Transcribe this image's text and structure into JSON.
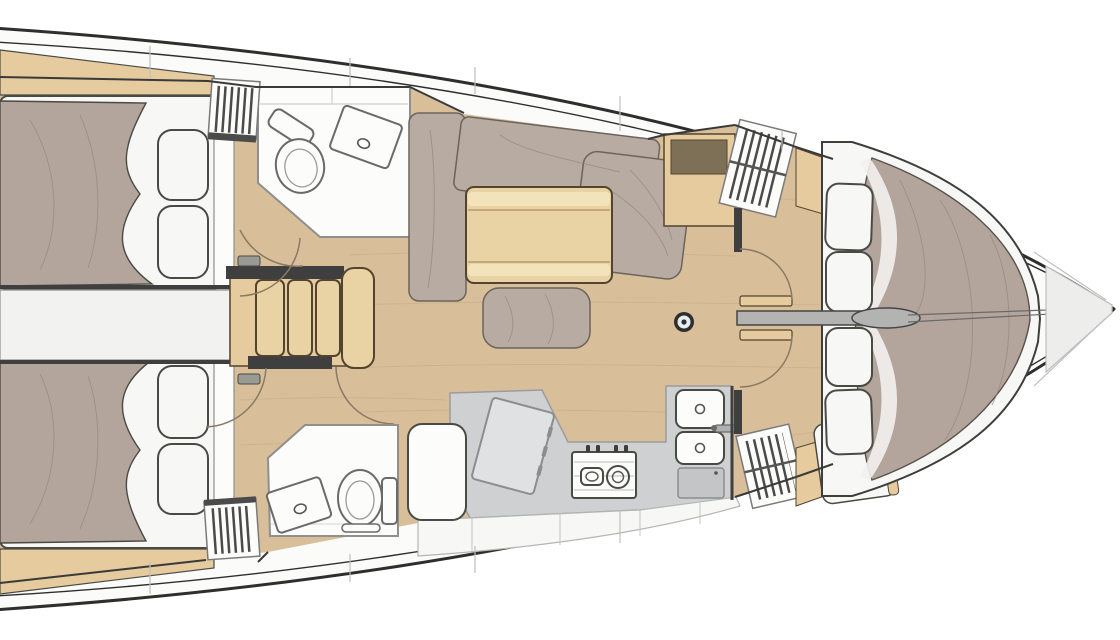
{
  "meta": {
    "title": "Sailing yacht interior layout plan, top view, bow to the right",
    "view": "overhead deck plan",
    "visible_text": "none"
  },
  "palette": {
    "background": "#ffffff",
    "hull_outline": "#2e2e2e",
    "deck_white": "#fbfbfa",
    "floor_wood": "#d8bf99",
    "wood_grain": "#c2a87f",
    "furniture_wood": "#e5cb9e",
    "table_wood": "#e9d2a4",
    "table_band": "#f4e4bd",
    "wood_edge": "#53442f",
    "cushion": "#b8aba2",
    "cushion_crease": "#8f847b",
    "bedding": "#b3a59b",
    "pillow_white": "#f7f7f5",
    "fixture_white": "#fcfcfb",
    "room_border": "#8f8f8f",
    "counter_gray": "#ced0d1",
    "panel_gray": "#dfe1e2",
    "hatch_gray": "#c3c5c6",
    "wall_dark": "#3f3f3f",
    "outline_dark": "#4a4a44",
    "slat_dark": "#4b4b4b",
    "locker_brown": "#7e6f57",
    "door_arc": "#8a7a64",
    "mast_ring": "#2f2f2f",
    "mast_center": "#e8edf0",
    "bow_panel": "#ededec",
    "seam_gray": "#bfbfbf",
    "corridor_white": "#f2f2f1"
  },
  "rooms": {
    "aft_cabin_port": "Aft cabin (port) with double berth and two pillows",
    "aft_cabin_starboard": "Aft cabin (starboard) with double berth and two pillows",
    "head_port": "Head (port) with toilet and washbasin",
    "head_starboard": "Head (starboard) with toilet and washbasin",
    "saloon": "Saloon with U-shaped settee, folding table, ottoman and mast post",
    "galley": "Galley with chart table, two-burner stove, double sink and lockers",
    "forward_cabins": "Forward V-berth split by centreline partition, four pillows",
    "companionway": "Companionway steps between the aft cabins",
    "engine_space": "Engine space between the aft cabins",
    "bow_locker": "Bow anchor locker"
  },
  "fixtures": {
    "berths": [
      "aft double berth port",
      "aft double berth starboard",
      "forward V-berth port",
      "forward V-berth starboard"
    ],
    "pillows_count": 8,
    "toilets_count": 2,
    "washbasins_count": 2,
    "galley_items": [
      "chart table",
      "nav seat",
      "two-burner stove",
      "double sink with faucet",
      "access hatch"
    ],
    "saloon_items": [
      "u-settee",
      "dining table",
      "ottoman",
      "mast post",
      "locker cabinet with dark lid"
    ],
    "louvered_lockers_count": 4,
    "door_swings_count": 6,
    "companionway_steps_count": 4
  }
}
